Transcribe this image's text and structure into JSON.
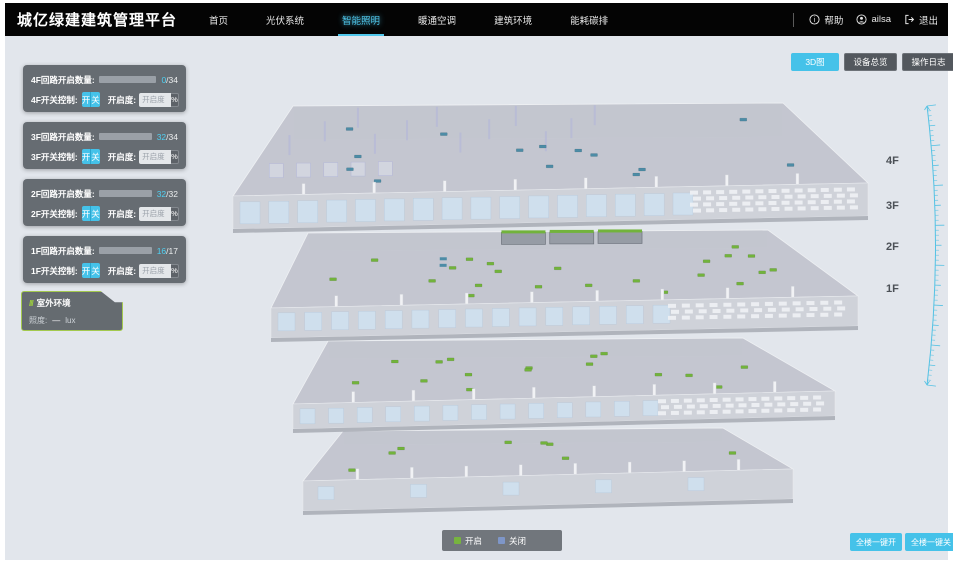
{
  "header": {
    "title": "城亿绿建建筑管理平台",
    "nav": [
      {
        "label": "首页"
      },
      {
        "label": "光伏系统"
      },
      {
        "label": "智能照明"
      },
      {
        "label": "暖通空调"
      },
      {
        "label": "建筑环境"
      },
      {
        "label": "能耗碳排"
      }
    ],
    "help_label": "帮助",
    "user_name": "ailsa",
    "logout_label": "退出"
  },
  "view_buttons": {
    "view_3d": "3D图",
    "device_overview": "设备总览",
    "operation_log": "操作日志"
  },
  "floor_panels": [
    {
      "circuit_label": "4F回路开启数量:",
      "open_count": "0",
      "total_suffix": "/34",
      "progress_pct": "0%",
      "switch_label": "4F开关控制:",
      "on_label": "开",
      "off_label": "关",
      "dim_label": "开启度:",
      "dim_placeholder": "开启度",
      "percent_label": "%"
    },
    {
      "circuit_label": "3F回路开启数量:",
      "open_count": "32",
      "total_suffix": "/34",
      "progress_pct": "94%",
      "switch_label": "3F开关控制:",
      "on_label": "开",
      "off_label": "关",
      "dim_label": "开启度:",
      "dim_placeholder": "开启度",
      "percent_label": "%"
    },
    {
      "circuit_label": "2F回路开启数量:",
      "open_count": "32",
      "total_suffix": "/32",
      "progress_pct": "100%",
      "switch_label": "2F开关控制:",
      "on_label": "开",
      "off_label": "关",
      "dim_label": "开启度:",
      "dim_placeholder": "开启度",
      "percent_label": "%"
    },
    {
      "circuit_label": "1F回路开启数量:",
      "open_count": "16",
      "total_suffix": "/17",
      "progress_pct": "94%",
      "switch_label": "1F开关控制:",
      "on_label": "开",
      "off_label": "关",
      "dim_label": "开启度:",
      "dim_placeholder": "开启度",
      "percent_label": "%"
    }
  ],
  "outdoor_panel": {
    "title": "室外环境",
    "illuminance_label": "照度:",
    "illuminance_value": "—",
    "illuminance_unit": "lux"
  },
  "floor_axis": {
    "f4": "4F",
    "f3": "3F",
    "f2": "2F",
    "f1": "1F"
  },
  "legend": {
    "on_label": "开启",
    "on_color": "#77b43f",
    "off_label": "关闭",
    "off_color": "#7e96c8"
  },
  "bottom_actions": {
    "all_on": "全楼一键开",
    "all_off": "全楼一键关"
  },
  "colors": {
    "accent": "#45c2e9",
    "light_on": "#72b33c",
    "light_off": "#4d8ca6"
  }
}
